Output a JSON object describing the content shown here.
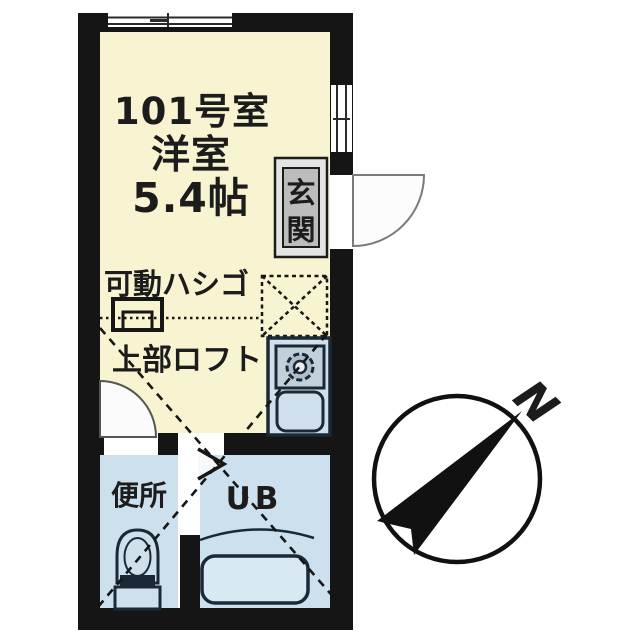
{
  "floor_plan": {
    "room": {
      "number": "101号室",
      "type": "洋室",
      "area": "5.4帖"
    },
    "entrance": {
      "label": "玄関"
    },
    "ladder": {
      "label": "可動ハシゴ"
    },
    "loft": {
      "label": "上部ロフト"
    },
    "toilet": {
      "label": "便所"
    },
    "unit_bath": {
      "label": "UB"
    },
    "compass": {
      "north_label": "N"
    }
  },
  "colors": {
    "wall": "#151515",
    "main_room_fill": "#f8f3d0",
    "wet_area_fill": "#cde0ed",
    "bathtub_fill": "#d9e9f3",
    "entrance_panel_fill": "#bcbcbc",
    "fixture_line": "#1b2836",
    "text": "#1c1c1c"
  }
}
